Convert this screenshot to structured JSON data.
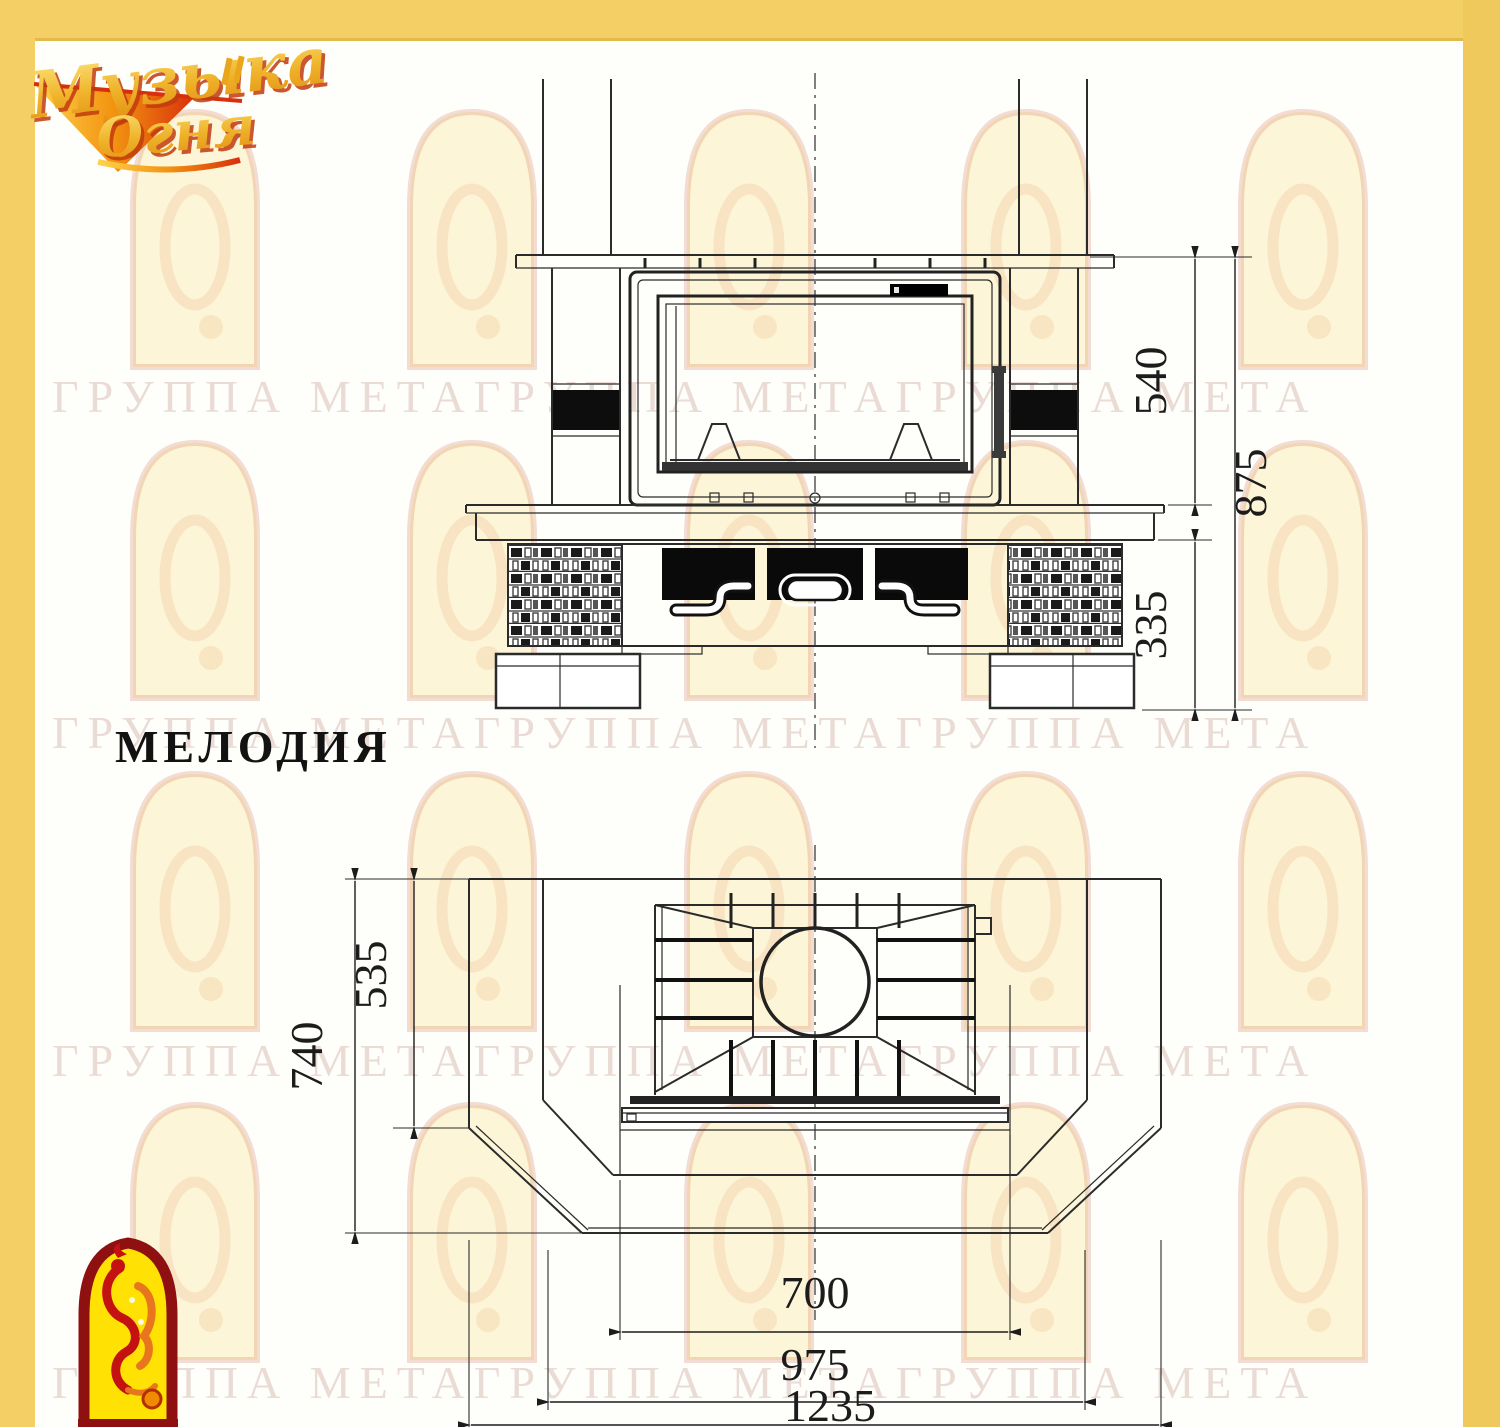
{
  "logo": {
    "line1": "Музыка",
    "line2": "Огня"
  },
  "model": {
    "name": "МЕЛОДИЯ"
  },
  "watermark": {
    "row": "ГРУППА МЕТАГРУППА МЕТАГРУППА МЕТА"
  },
  "front_view": {
    "dims": {
      "portal_height": "540",
      "total_height": "875",
      "base_height": "335"
    }
  },
  "plan_view": {
    "dims": {
      "total_depth": "740",
      "inner_depth": "535",
      "opening_width": "700",
      "inner_width": "975",
      "total_width": "1235"
    }
  },
  "colors": {
    "border_yellow": "#F3CF66",
    "border_edge": "#E2B94C",
    "logo_gold": "#E9A51B",
    "logo_red": "#D8300C",
    "firebird_red": "#C41111",
    "firebird_yellow": "#FFE104",
    "line_ink": "#2b2b2b"
  }
}
